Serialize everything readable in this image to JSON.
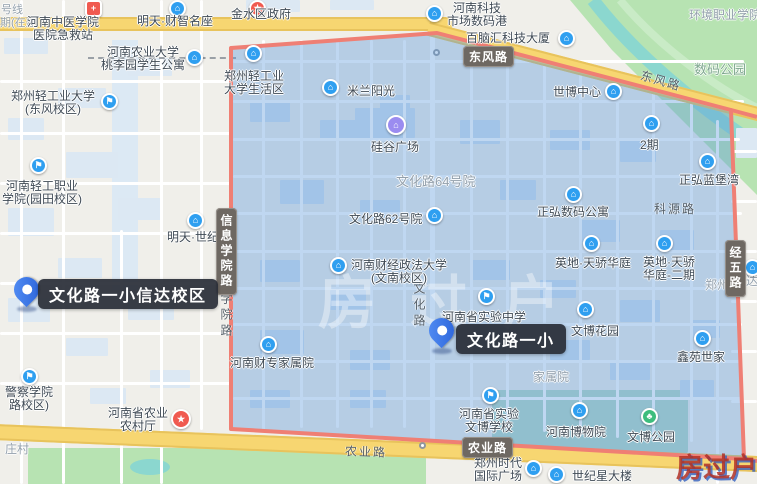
{
  "pins": [
    {
      "label": "文化路一小信达校区"
    },
    {
      "label": "文化路一小"
    }
  ],
  "highlight_region": {
    "points": "231,48 437,33 731,110 744,459 231,429",
    "border_color": "#ef7f74",
    "fill_color": "rgba(95,155,220,0.40)"
  },
  "road_badges": [
    {
      "label": "东风路",
      "x": 463,
      "y": 46,
      "vertical": false
    },
    {
      "label": "农业路",
      "x": 462,
      "y": 437,
      "vertical": false
    },
    {
      "label": "信息学院路",
      "x": 216,
      "y": 208,
      "vertical": true
    },
    {
      "label": "经五路",
      "x": 725,
      "y": 240,
      "vertical": true
    }
  ],
  "road_names": [
    {
      "label": "东风路",
      "x": 640,
      "y": 72,
      "rotate": 16,
      "vertical": false
    },
    {
      "label": "农业路",
      "x": 345,
      "y": 443,
      "rotate": 2,
      "vertical": false
    },
    {
      "label": "科源路",
      "x": 654,
      "y": 200,
      "rotate": 0,
      "vertical": false
    },
    {
      "label": "文化路",
      "x": 411,
      "y": 282,
      "rotate": 0,
      "vertical": true
    },
    {
      "label": "学院路",
      "x": 218,
      "y": 292,
      "rotate": 0,
      "vertical": true
    }
  ],
  "area_labels": [
    {
      "label": "文化路64号院",
      "x": 396,
      "y": 171,
      "size": 13
    },
    {
      "label": "家属院",
      "x": 533,
      "y": 368,
      "size": 12
    },
    {
      "label": "数码公园",
      "x": 694,
      "y": 59,
      "size": 13,
      "color": "#7fa88f"
    },
    {
      "label": "庄村",
      "x": 5,
      "y": 440,
      "size": 12
    },
    {
      "label": "环境职业学院",
      "x": 689,
      "y": 6,
      "size": 12
    },
    {
      "label": "郑州",
      "x": 705,
      "y": 276,
      "size": 12
    },
    {
      "label": "达",
      "x": 746,
      "y": 272,
      "size": 12
    },
    {
      "label": "号线",
      "x": 1,
      "y": 1,
      "size": 11
    },
    {
      "label": "期(在建",
      "x": 0,
      "y": 14,
      "size": 11
    }
  ],
  "pois": [
    {
      "lines": [
        "河南中医学院",
        "医院急救站"
      ],
      "x": 27,
      "y": 16,
      "icon": {
        "name": "hospital-icon",
        "glyph": "+",
        "color": "#f05a50",
        "x": 85,
        "y": 0,
        "shape": "square"
      }
    },
    {
      "lines": [
        "明天·财智名座"
      ],
      "x": 137,
      "y": 15,
      "icon": {
        "name": "building-icon",
        "glyph": "⌂",
        "color": "#2f9ff0",
        "x": 169,
        "y": 0
      }
    },
    {
      "lines": [
        "金水区政府"
      ],
      "x": 231,
      "y": 8,
      "icon": {
        "name": "government-icon",
        "glyph": "★",
        "color": "#f05a50",
        "x": 249,
        "y": 0
      }
    },
    {
      "lines": [
        "河南农业大学",
        "桃李园学生公寓"
      ],
      "x": 101,
      "y": 46,
      "w": 84,
      "icon": {
        "name": "building-icon",
        "glyph": "⌂",
        "color": "#2f9ff0",
        "x": 186,
        "y": 49
      }
    },
    {
      "lines": [
        "郑州轻工业大学",
        "(东风校区)"
      ],
      "x": 10,
      "y": 90,
      "w": 86,
      "icon": {
        "name": "graduation-cap-icon",
        "glyph": "⚑",
        "color": "#2f9ff0",
        "x": 101,
        "y": 93
      }
    },
    {
      "lines": [
        "河南轻工职业",
        "学院(园田校区)"
      ],
      "x": 0,
      "y": 180,
      "w": 84,
      "icon": {
        "name": "graduation-cap-icon",
        "glyph": "⚑",
        "color": "#2f9ff0",
        "x": 30,
        "y": 157
      }
    },
    {
      "lines": [
        "明天·世纪"
      ],
      "x": 167,
      "y": 231,
      "icon": {
        "name": "building-icon",
        "glyph": "⌂",
        "color": "#2f9ff0",
        "x": 187,
        "y": 212
      }
    },
    {
      "lines": [
        "警察学院",
        "路校区)"
      ],
      "x": 0,
      "y": 386,
      "w": 58,
      "icon": {
        "name": "graduation-cap-icon",
        "glyph": "⚑",
        "color": "#2f9ff0",
        "x": 21,
        "y": 368
      }
    },
    {
      "lines": [
        "河南省农业",
        "农村厅"
      ],
      "x": 107,
      "y": 407,
      "w": 62,
      "icon": {
        "name": "star-icon",
        "glyph": "★",
        "color": "#f05a50",
        "x": 171,
        "y": 409,
        "size": 20
      }
    },
    {
      "lines": [
        "河南科技",
        "市场数码港"
      ],
      "x": 446,
      "y": 2,
      "w": 62,
      "icon": {
        "name": "building-icon",
        "glyph": "⌂",
        "color": "#2f9ff0",
        "x": 426,
        "y": 5
      }
    },
    {
      "lines": [
        "百脑汇科技大厦"
      ],
      "x": 466,
      "y": 32,
      "icon": {
        "name": "building-icon",
        "glyph": "⌂",
        "color": "#2f9ff0",
        "x": 558,
        "y": 30
      }
    },
    {
      "lines": [
        "世博中心"
      ],
      "x": 553,
      "y": 86,
      "icon": {
        "name": "building-icon",
        "glyph": "⌂",
        "color": "#2f9ff0",
        "x": 605,
        "y": 83
      }
    },
    {
      "lines": [
        "郑州轻工业",
        "大学生活区"
      ],
      "x": 223,
      "y": 70,
      "w": 62,
      "icon": {
        "name": "building-icon",
        "glyph": "⌂",
        "color": "#2f9ff0",
        "x": 245,
        "y": 45
      }
    },
    {
      "lines": [
        "米兰阳光"
      ],
      "x": 347,
      "y": 85,
      "icon": {
        "name": "building-icon",
        "glyph": "⌂",
        "color": "#2f9ff0",
        "x": 322,
        "y": 79
      }
    },
    {
      "lines": [
        "硅谷广场"
      ],
      "x": 371,
      "y": 141,
      "icon": {
        "name": "shopping-bag-icon",
        "glyph": "⌂",
        "color": "#9b8cf0",
        "x": 386,
        "y": 115,
        "size": 20
      }
    },
    {
      "lines": [
        "文化路62号院"
      ],
      "x": 349,
      "y": 213,
      "icon": {
        "name": "building-icon",
        "glyph": "⌂",
        "color": "#2f9ff0",
        "x": 426,
        "y": 207
      }
    },
    {
      "lines": [
        "河南财经政法大学",
        "(文南校区)"
      ],
      "x": 350,
      "y": 259,
      "w": 98,
      "icon": {
        "name": "building-icon",
        "glyph": "⌂",
        "color": "#2f9ff0",
        "x": 330,
        "y": 257
      }
    },
    {
      "lines": [
        "河南省实验中学"
      ],
      "x": 442,
      "y": 311,
      "icon": {
        "name": "flag-icon",
        "glyph": "⚑",
        "color": "#2f9ff0",
        "x": 478,
        "y": 288
      }
    },
    {
      "lines": [
        "2期"
      ],
      "x": 640,
      "y": 139,
      "icon": {
        "name": "building-icon",
        "glyph": "⌂",
        "color": "#2f9ff0",
        "x": 643,
        "y": 115
      }
    },
    {
      "lines": [
        "正弘蓝堡湾"
      ],
      "x": 679,
      "y": 174,
      "icon": {
        "name": "building-icon",
        "glyph": "⌂",
        "color": "#2f9ff0",
        "x": 699,
        "y": 153
      }
    },
    {
      "lines": [
        "正弘数码公寓"
      ],
      "x": 537,
      "y": 206,
      "icon": {
        "name": "building-icon",
        "glyph": "⌂",
        "color": "#2f9ff0",
        "x": 565,
        "y": 186
      }
    },
    {
      "lines": [
        "英地·天骄华庭"
      ],
      "x": 555,
      "y": 257,
      "icon": {
        "name": "building-icon",
        "glyph": "⌂",
        "color": "#2f9ff0",
        "x": 583,
        "y": 235
      }
    },
    {
      "lines": [
        "英地·天骄",
        "华庭-二期"
      ],
      "x": 640,
      "y": 256,
      "w": 58,
      "icon": {
        "name": "building-icon",
        "glyph": "⌂",
        "color": "#2f9ff0",
        "x": 656,
        "y": 235
      }
    },
    {
      "lines": [
        "文博花园"
      ],
      "x": 571,
      "y": 325,
      "icon": {
        "name": "building-icon",
        "glyph": "⌂",
        "color": "#2f9ff0",
        "x": 577,
        "y": 301
      }
    },
    {
      "lines": [
        "鑫苑世家"
      ],
      "x": 677,
      "y": 351,
      "icon": {
        "name": "building-icon",
        "glyph": "⌂",
        "color": "#2f9ff0",
        "x": 694,
        "y": 330
      }
    },
    {
      "lines": [
        "河南财专家属院"
      ],
      "x": 230,
      "y": 357,
      "icon": {
        "name": "building-icon",
        "glyph": "⌂",
        "color": "#2f9ff0",
        "x": 260,
        "y": 336
      }
    },
    {
      "lines": [
        "河南省实验",
        "文博学校"
      ],
      "x": 458,
      "y": 408,
      "w": 62,
      "icon": {
        "name": "flag-icon",
        "glyph": "⚑",
        "color": "#2f9ff0",
        "x": 482,
        "y": 387
      }
    },
    {
      "lines": [
        "河南博物院"
      ],
      "x": 546,
      "y": 426,
      "icon": {
        "name": "museum-icon",
        "glyph": "⌂",
        "color": "#2f9ff0",
        "x": 571,
        "y": 402
      }
    },
    {
      "lines": [
        "文博公园"
      ],
      "x": 627,
      "y": 431,
      "icon": {
        "name": "park-icon",
        "glyph": "♣",
        "color": "#3dbd7d",
        "x": 641,
        "y": 408
      }
    },
    {
      "lines": [
        "郑州时代",
        "国际广场"
      ],
      "x": 471,
      "y": 457,
      "w": 54,
      "icon": {
        "name": "building-icon",
        "glyph": "⌂",
        "color": "#2f9ff0",
        "x": 525,
        "y": 460
      }
    },
    {
      "lines": [
        "世纪星大楼"
      ],
      "x": 572,
      "y": 470,
      "icon": {
        "name": "building-icon",
        "glyph": "⌂",
        "color": "#2f9ff0",
        "x": 548,
        "y": 466
      }
    },
    {
      "lines": [],
      "icon": {
        "name": "building-icon",
        "glyph": "⌂",
        "color": "#2f9ff0",
        "x": 744,
        "y": 259
      }
    }
  ],
  "watermarks": {
    "center": "房过户",
    "corner": "房过户"
  }
}
